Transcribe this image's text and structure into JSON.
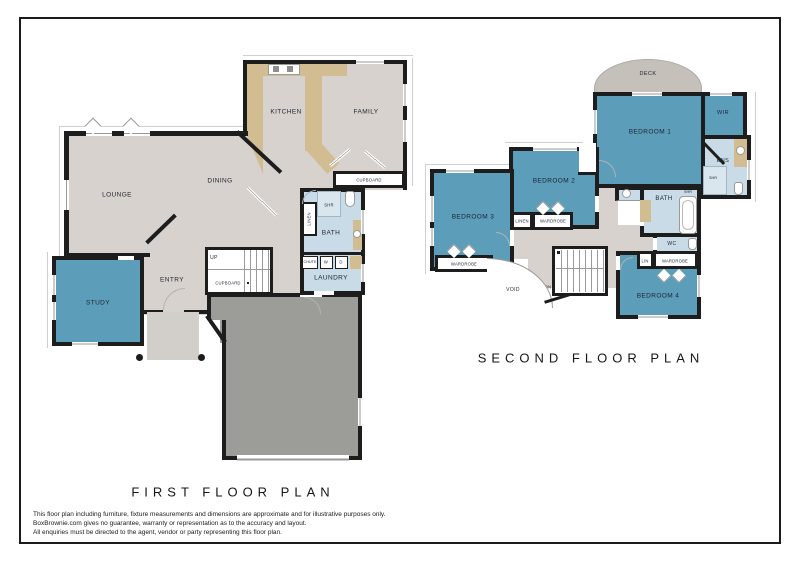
{
  "first_floor": {
    "title": "FIRST FLOOR PLAN",
    "labels": {
      "kitchen": "KITCHEN",
      "family": "FAMILY",
      "dining": "DINING",
      "lounge": "LOUNGE",
      "study": "STUDY",
      "entry": "ENTRY",
      "up": "UP",
      "stairs_cupboard": "CUPBOARD",
      "hall_cupboard": "CUPBOARD",
      "linen": "LINEN",
      "shower": "SHR",
      "bath": "BATH",
      "chute": "CHUTE",
      "washer": "W",
      "dryer": "D",
      "laundry": "LAUNDRY"
    }
  },
  "second_floor": {
    "title": "SECOND FLOOR PLAN",
    "labels": {
      "deck": "DECK",
      "bedroom1": "BEDROOM 1",
      "bedroom2": "BEDROOM 2",
      "bedroom3": "BEDROOM 3",
      "bedroom4": "BEDROOM 4",
      "wir": "WIR",
      "ens": "ENS",
      "ens_shower": "SHR",
      "bath": "BATH",
      "bath_shower": "SHR",
      "wc": "WC",
      "linen": "LINEN",
      "lin": "LIN",
      "wardrobe_bed2": "WARDROBE",
      "wardrobe_bed3": "WARDROBE",
      "wardrobe_bed4": "WARDROBE",
      "void": "VOID",
      "dn": "DN"
    }
  },
  "disclaimer": {
    "line1": "This floor plan including furniture, fixture measurements and dimensions are approximate and for illustrative purposes only.",
    "line2": "BoxBrownie.com gives no guarantee, warranty or representation as to the accuracy and layout.",
    "line3": "All enquiries must be directed to the agent, vendor or party representing this floor plan."
  },
  "colors": {
    "wall": "#1d1d1d",
    "room_blue": "#5c9db9",
    "wet_area_blue": "#c9dbe7",
    "floor_beige": "#d8d2ce",
    "garage_grey": "#9c9c98",
    "deck_grey": "#c5c0b9",
    "counter_tan": "#d2bc92",
    "porch_grey": "#d2cfca"
  }
}
